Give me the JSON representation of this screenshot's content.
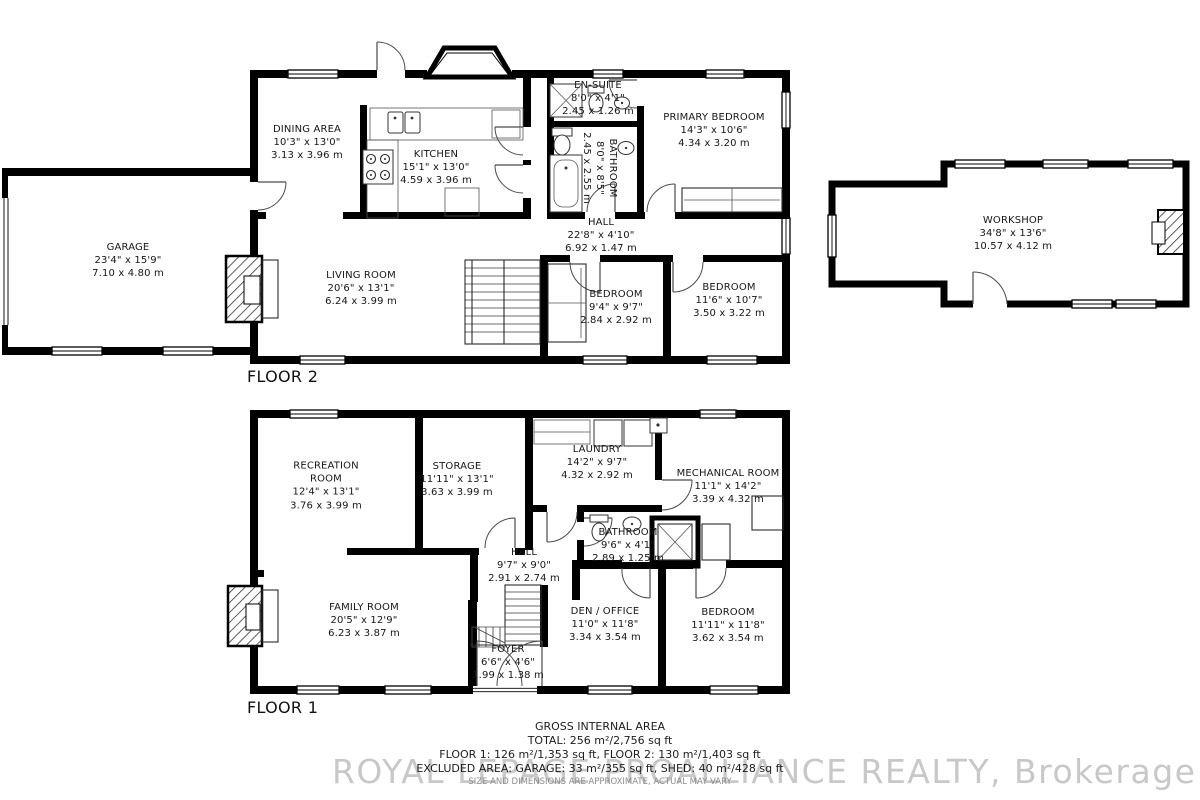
{
  "floor2": {
    "label": "FLOOR 2",
    "rooms": {
      "garage": {
        "name": "GARAGE",
        "imp": "23'4\" x 15'9\"",
        "met": "7.10 x 4.80 m"
      },
      "dining": {
        "name": "DINING AREA",
        "imp": "10'3\" x 13'0\"",
        "met": "3.13 x 3.96 m"
      },
      "kitchen": {
        "name": "KITCHEN",
        "imp": "15'1\" x 13'0\"",
        "met": "4.59 x 3.96 m"
      },
      "ensuite": {
        "name": "EN-SUITE",
        "imp": "8'0\" x 4'1\"",
        "met": "2.45 x 1.26 m"
      },
      "bathroom": {
        "name": "BATHROOM",
        "imp": "8'0\" x 8'5\"",
        "met": "2.45 x 2.55 m"
      },
      "primary": {
        "name": "PRIMARY BEDROOM",
        "imp": "14'3\" x 10'6\"",
        "met": "4.34 x 3.20 m"
      },
      "hall": {
        "name": "HALL",
        "imp": "22'8\" x 4'10\"",
        "met": "6.92 x 1.47 m"
      },
      "living": {
        "name": "LIVING ROOM",
        "imp": "20'6\" x 13'1\"",
        "met": "6.24 x 3.99 m"
      },
      "bedroom1": {
        "name": "BEDROOM",
        "imp": "9'4\" x 9'7\"",
        "met": "2.84 x 2.92 m"
      },
      "bedroom2": {
        "name": "BEDROOM",
        "imp": "11'6\" x 10'7\"",
        "met": "3.50 x 3.22 m"
      }
    }
  },
  "workshop": {
    "name": "WORKSHOP",
    "imp": "34'8\" x 13'6\"",
    "met": "10.57 x 4.12 m"
  },
  "floor1": {
    "label": "FLOOR 1",
    "rooms": {
      "recreation": {
        "name": "RECREATION ROOM",
        "imp": "12'4\" x 13'1\"",
        "met": "3.76 x 3.99 m"
      },
      "storage": {
        "name": "STORAGE",
        "imp": "11'11\" x 13'1\"",
        "met": "3.63 x 3.99 m"
      },
      "laundry": {
        "name": "LAUNDRY",
        "imp": "14'2\" x 9'7\"",
        "met": "4.32 x 2.92 m"
      },
      "mechanical": {
        "name": "MECHANICAL ROOM",
        "imp": "11'1\" x 14'2\"",
        "met": "3.39 x 4.32 m"
      },
      "bathroom": {
        "name": "BATHROOM",
        "imp": "9'6\" x 4'1\"",
        "met": "2.89 x 1.25 m"
      },
      "hall": {
        "name": "HALL",
        "imp": "9'7\" x 9'0\"",
        "met": "2.91 x 2.74 m"
      },
      "family": {
        "name": "FAMILY ROOM",
        "imp": "20'5\" x 12'9\"",
        "met": "6.23 x 3.87 m"
      },
      "den": {
        "name": "DEN / OFFICE",
        "imp": "11'0\" x 11'8\"",
        "met": "3.34 x 3.54 m"
      },
      "bedroom": {
        "name": "BEDROOM",
        "imp": "11'11\" x 11'8\"",
        "met": "3.62 x 3.54 m"
      },
      "foyer": {
        "name": "FOYER",
        "imp": "6'6\" x 4'6\"",
        "met": "1.99 x 1.38 m"
      }
    }
  },
  "footer": {
    "title": "GROSS INTERNAL AREA",
    "total": "TOTAL: 256 m²/2,756 sq ft",
    "floors": "FLOOR 1: 126 m²/1,353 sq ft, FLOOR 2: 130 m²/1,403 sq ft",
    "excluded": "EXCLUDED AREA: GARAGE: 33 m²/355 sq ft, SHED: 40 m²/428 sq ft",
    "disclaimer": "SIZE AND DIMENSIONS ARE APPROXIMATE, ACTUAL MAY VARY",
    "watermark": "ROYAL LEPAGE PROALLIANCE REALTY, Brokerage"
  },
  "colors": {
    "walls": "#000000",
    "text": "#161616",
    "watermark": "#c8c8c8"
  }
}
